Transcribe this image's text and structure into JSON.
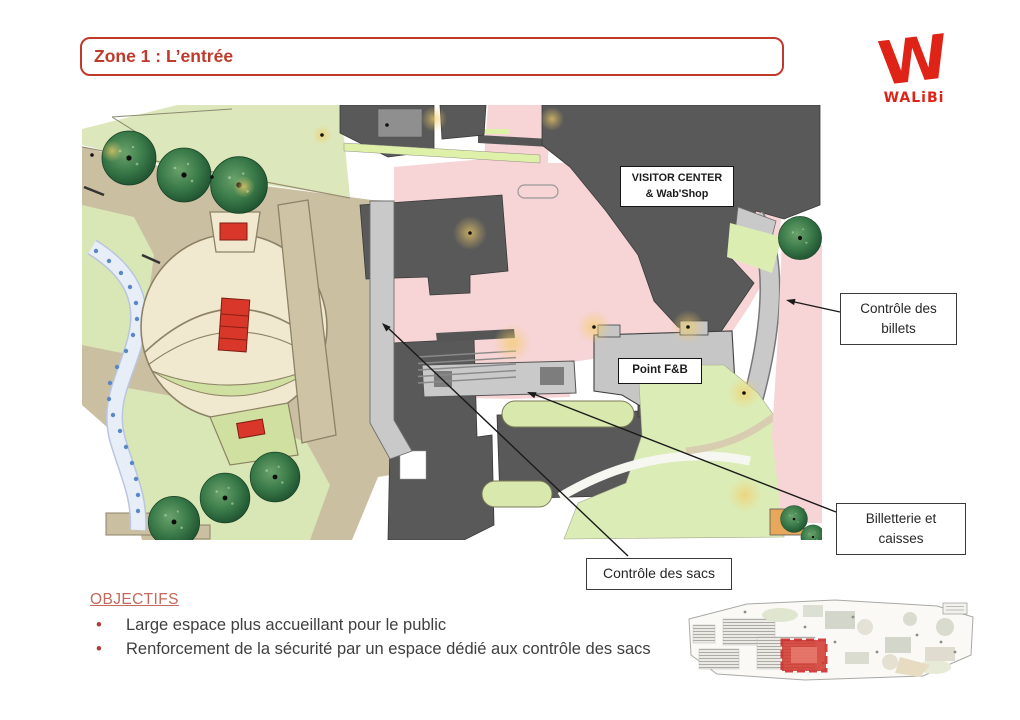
{
  "slide": {
    "title": "Zone 1 : L’entrée",
    "background": "#ffffff",
    "accent_red": "#bf3a2b"
  },
  "logo": {
    "glyph": "W",
    "wordmark": "WALiBi",
    "color": "#e02317"
  },
  "map": {
    "visitor_center": {
      "lines": [
        "VISITOR CENTER",
        "& Wab'Shop"
      ]
    },
    "point_fb": {
      "label": "Point F&B"
    },
    "callouts": {
      "billets": {
        "lines": [
          "Contrôle des",
          "billets"
        ]
      },
      "billetterie": {
        "lines": [
          "Billetterie et",
          "caisses"
        ]
      },
      "sacs": {
        "lines": [
          "Contrôle des sacs"
        ]
      }
    },
    "colors": {
      "zone_pink": "#f7d4d6",
      "building_dark": "#595959",
      "walkway_gray": "#c9c9c9",
      "lawn_green": "#dce8bb",
      "plaza_cream": "#f0e9cf",
      "path_tan": "#cbbfa2",
      "tree_green": "#2f6b3f",
      "water_blue": "#5b87c7",
      "stage_red": "#d8372a"
    }
  },
  "objectives": {
    "heading": "OBJECTIFS",
    "bullets": [
      "Large espace plus accueillant pour le public",
      "Renforcement de la sécurité par un espace dédié aux contrôle des sacs"
    ]
  },
  "minimap": {
    "highlight_color": "#d2362c"
  }
}
